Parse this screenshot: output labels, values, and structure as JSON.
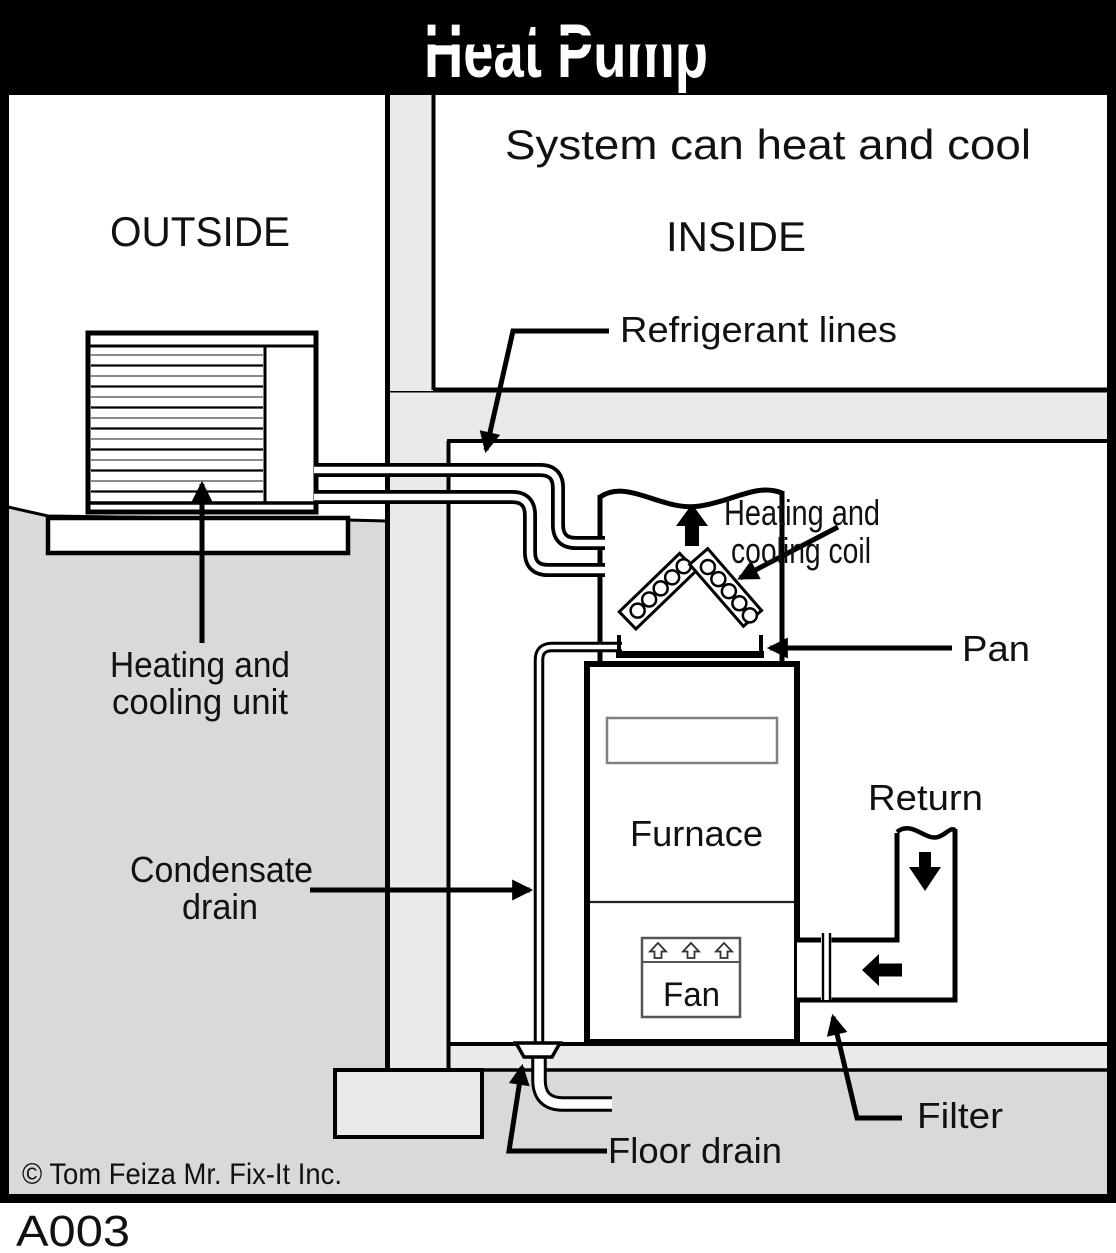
{
  "title": "Heat Pump",
  "subtitle": "System can heat and cool",
  "areas": {
    "outside": "OUTSIDE",
    "inside": "INSIDE"
  },
  "labels": {
    "refrigerant_lines": "Refrigerant lines",
    "coil_line1": "Heating and",
    "coil_line2": "cooling coil",
    "pan": "Pan",
    "furnace": "Furnace",
    "fan": "Fan",
    "return_duct": "Return",
    "unit_line1": "Heating and",
    "unit_line2": "cooling unit",
    "condensate_line1": "Condensate",
    "condensate_line2": "drain",
    "filter": "Filter",
    "floor_drain": "Floor drain"
  },
  "footer": {
    "copyright": "© Tom Feiza Mr. Fix-It Inc.",
    "code": "A003"
  },
  "colors": {
    "ground": "#d8d9da",
    "structure": "#e9eaeb",
    "ink": "#000000",
    "title_bg": "#000000",
    "title_fg": "#ffffff"
  }
}
